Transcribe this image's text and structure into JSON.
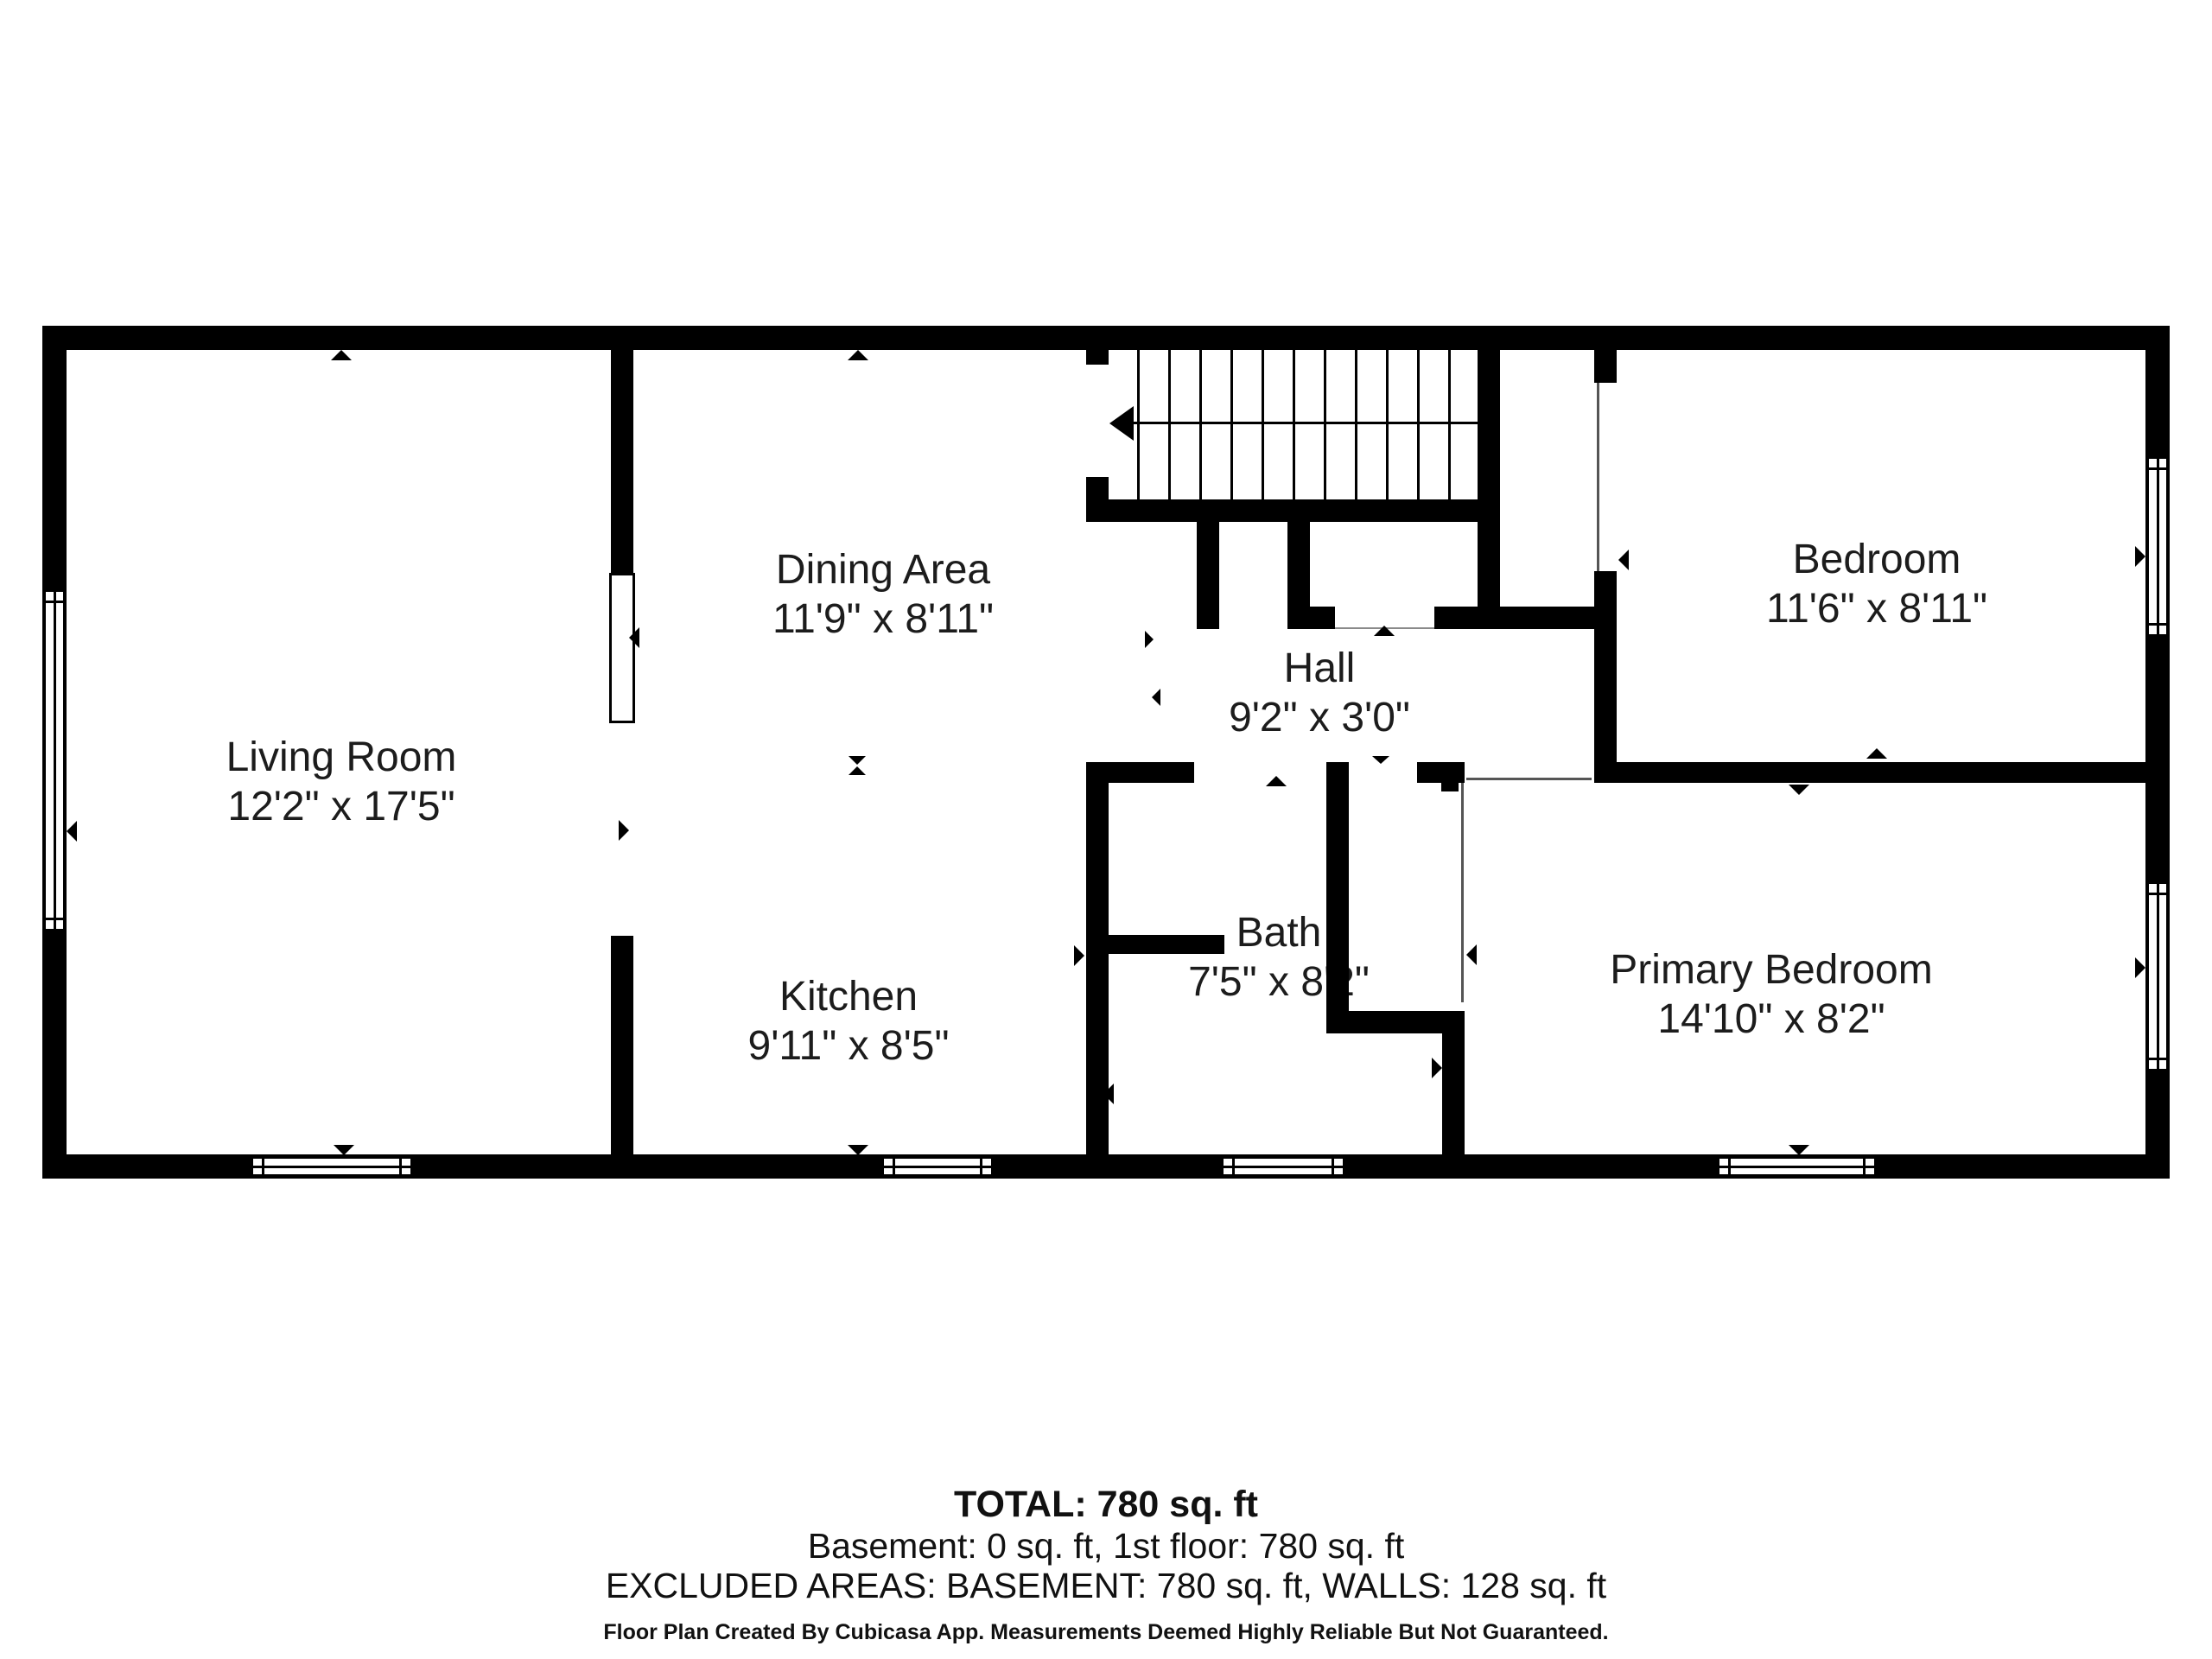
{
  "rooms": {
    "living": {
      "name": "Living Room",
      "dims": "12'2\" x 17'5\""
    },
    "dining": {
      "name": "Dining Area",
      "dims": "11'9\" x 8'11\""
    },
    "kitchen": {
      "name": "Kitchen",
      "dims": "9'11\" x 8'5\""
    },
    "hall": {
      "name": "Hall",
      "dims": "9'2\" x 3'0\""
    },
    "bath": {
      "name": "Bath",
      "dims": "7'5\" x 8'2\""
    },
    "bedroom": {
      "name": "Bedroom",
      "dims": "11'6\" x 8'11\""
    },
    "primary": {
      "name": "Primary Bedroom",
      "dims": "14'10\" x 8'2\""
    }
  },
  "summary": {
    "total": "TOTAL: 780 sq. ft",
    "floors": "Basement: 0 sq. ft, 1st floor: 780 sq. ft",
    "excluded": "EXCLUDED AREAS: BASEMENT: 780 sq. ft, WALLS: 128 sq. ft",
    "disclaimer": "Floor Plan Created By Cubicasa App. Measurements Deemed Highly Reliable But Not Guaranteed."
  },
  "colors": {
    "wall": "#000000",
    "text": "#1c1c1c",
    "background": "#ffffff"
  }
}
